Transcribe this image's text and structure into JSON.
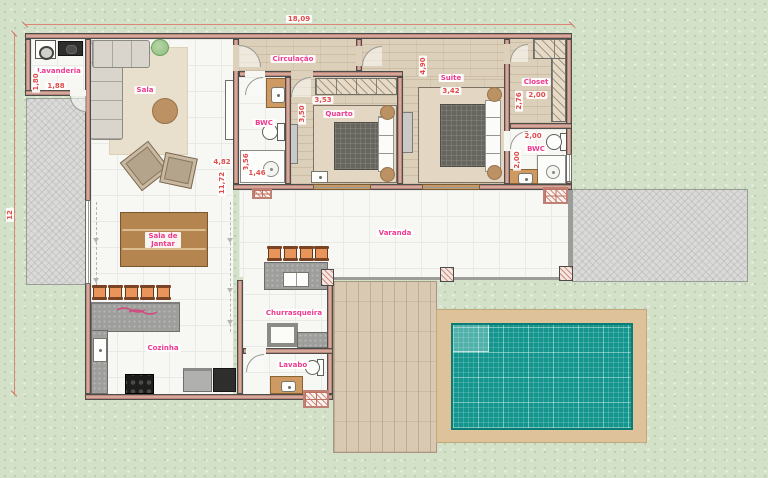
{
  "rooms": [
    {
      "id": "lavanderia",
      "label": "Lavanderia"
    },
    {
      "id": "sala",
      "label": "Sala"
    },
    {
      "id": "circulacao",
      "label": "Circulação"
    },
    {
      "id": "bwc-left",
      "label": "BWC"
    },
    {
      "id": "quarto",
      "label": "Quarto"
    },
    {
      "id": "suite",
      "label": "Suite"
    },
    {
      "id": "closet",
      "label": "Closet"
    },
    {
      "id": "bwc-right",
      "label": "BWC"
    },
    {
      "id": "sala-de-jantar",
      "label": "Sala de Jantar"
    },
    {
      "id": "varanda",
      "label": "Varanda"
    },
    {
      "id": "cozinha",
      "label": "Cozinha"
    },
    {
      "id": "churrasqueira",
      "label": "Churrasqueira"
    },
    {
      "id": "lavabo",
      "label": "Lavabo"
    }
  ],
  "dimensions": [
    {
      "id": "site-width",
      "text": "18,09"
    },
    {
      "id": "site-height",
      "text": "12"
    },
    {
      "id": "lavanderia-depth",
      "text": "1,80"
    },
    {
      "id": "lavanderia-width",
      "text": "1,88"
    },
    {
      "id": "sala-width",
      "text": "4,82"
    },
    {
      "id": "sala-depth",
      "text": "11,72"
    },
    {
      "id": "bwc-left-depth",
      "text": "3,56"
    },
    {
      "id": "bwc-left-width",
      "text": "1,46"
    },
    {
      "id": "quarto-width",
      "text": "3,53"
    },
    {
      "id": "quarto-depth",
      "text": "3,50"
    },
    {
      "id": "suite-depth",
      "text": "4,90"
    },
    {
      "id": "suite-width",
      "text": "3,42"
    },
    {
      "id": "closet-depth",
      "text": "2,76"
    },
    {
      "id": "closet-width",
      "text": "2,00"
    },
    {
      "id": "bwc-right-width",
      "text": "2,00"
    },
    {
      "id": "bwc-right-depth",
      "text": "2,00"
    }
  ],
  "colors": {
    "background_green": "#d4e1c9",
    "wall_salmon": "#d6a79b",
    "label_pink": "#ee3a90",
    "dimension_red": "#e04b4b",
    "pool_teal": "#14968e",
    "pool_deck_tan": "#dec29a",
    "wood_deck": "#d9c9b3",
    "paving_gray": "#dadbd8",
    "counter_gray": "#9e9e9c",
    "floor_wood": "#ddd0bb",
    "floor_tile": "#f7f7f4",
    "stool_orange": "#e8945a",
    "table_wood": "#b5854f"
  }
}
